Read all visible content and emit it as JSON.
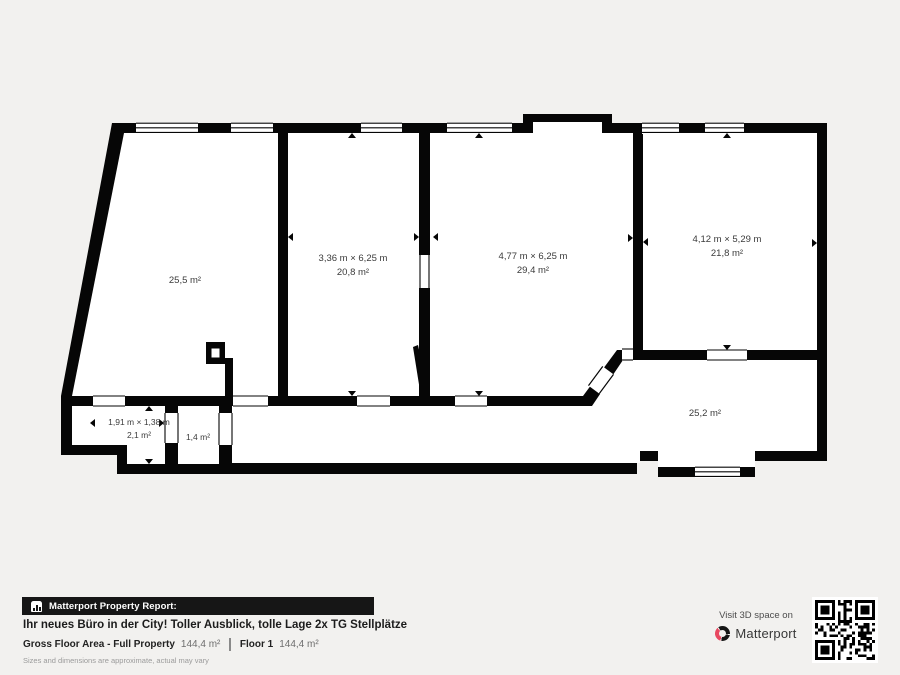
{
  "plan": {
    "rooms": [
      {
        "id": "room-1",
        "area": "25,5 m²"
      },
      {
        "id": "room-2",
        "dimensions": "3,36 m × 6,25 m",
        "area": "20,8 m²"
      },
      {
        "id": "room-3",
        "dimensions": "4,77 m × 6,25 m",
        "area": "29,4 m²"
      },
      {
        "id": "room-4",
        "dimensions": "4,12 m × 5,29 m",
        "area": "21,8 m²"
      },
      {
        "id": "corridor",
        "area": "25,2 m²"
      },
      {
        "id": "small-room-1",
        "dimensions": "1,91 m × 1,38 m",
        "area": "2,1 m²"
      },
      {
        "id": "small-room-2",
        "area": "1,4 m²"
      }
    ],
    "wall_color": "#000000",
    "floor_color": "#ffffff",
    "background_color": "#f2f1ef"
  },
  "footer": {
    "report_label": "Matterport Property Report:",
    "title": "Ihr neues Büro in der City! Toller Ausblick, tolle Lage 2x TG Stellplätze",
    "gross_label": "Gross Floor Area - Full Property",
    "gross_value": "144,4 m²",
    "floor_label": "Floor 1",
    "floor_value": "144,4 m²",
    "disclaimer": "Sizes and dimensions are approximate, actual may vary"
  },
  "cta": {
    "visit_label": "Visit 3D space on",
    "brand": "Matterport",
    "brand_accent_color": "#e84860"
  }
}
